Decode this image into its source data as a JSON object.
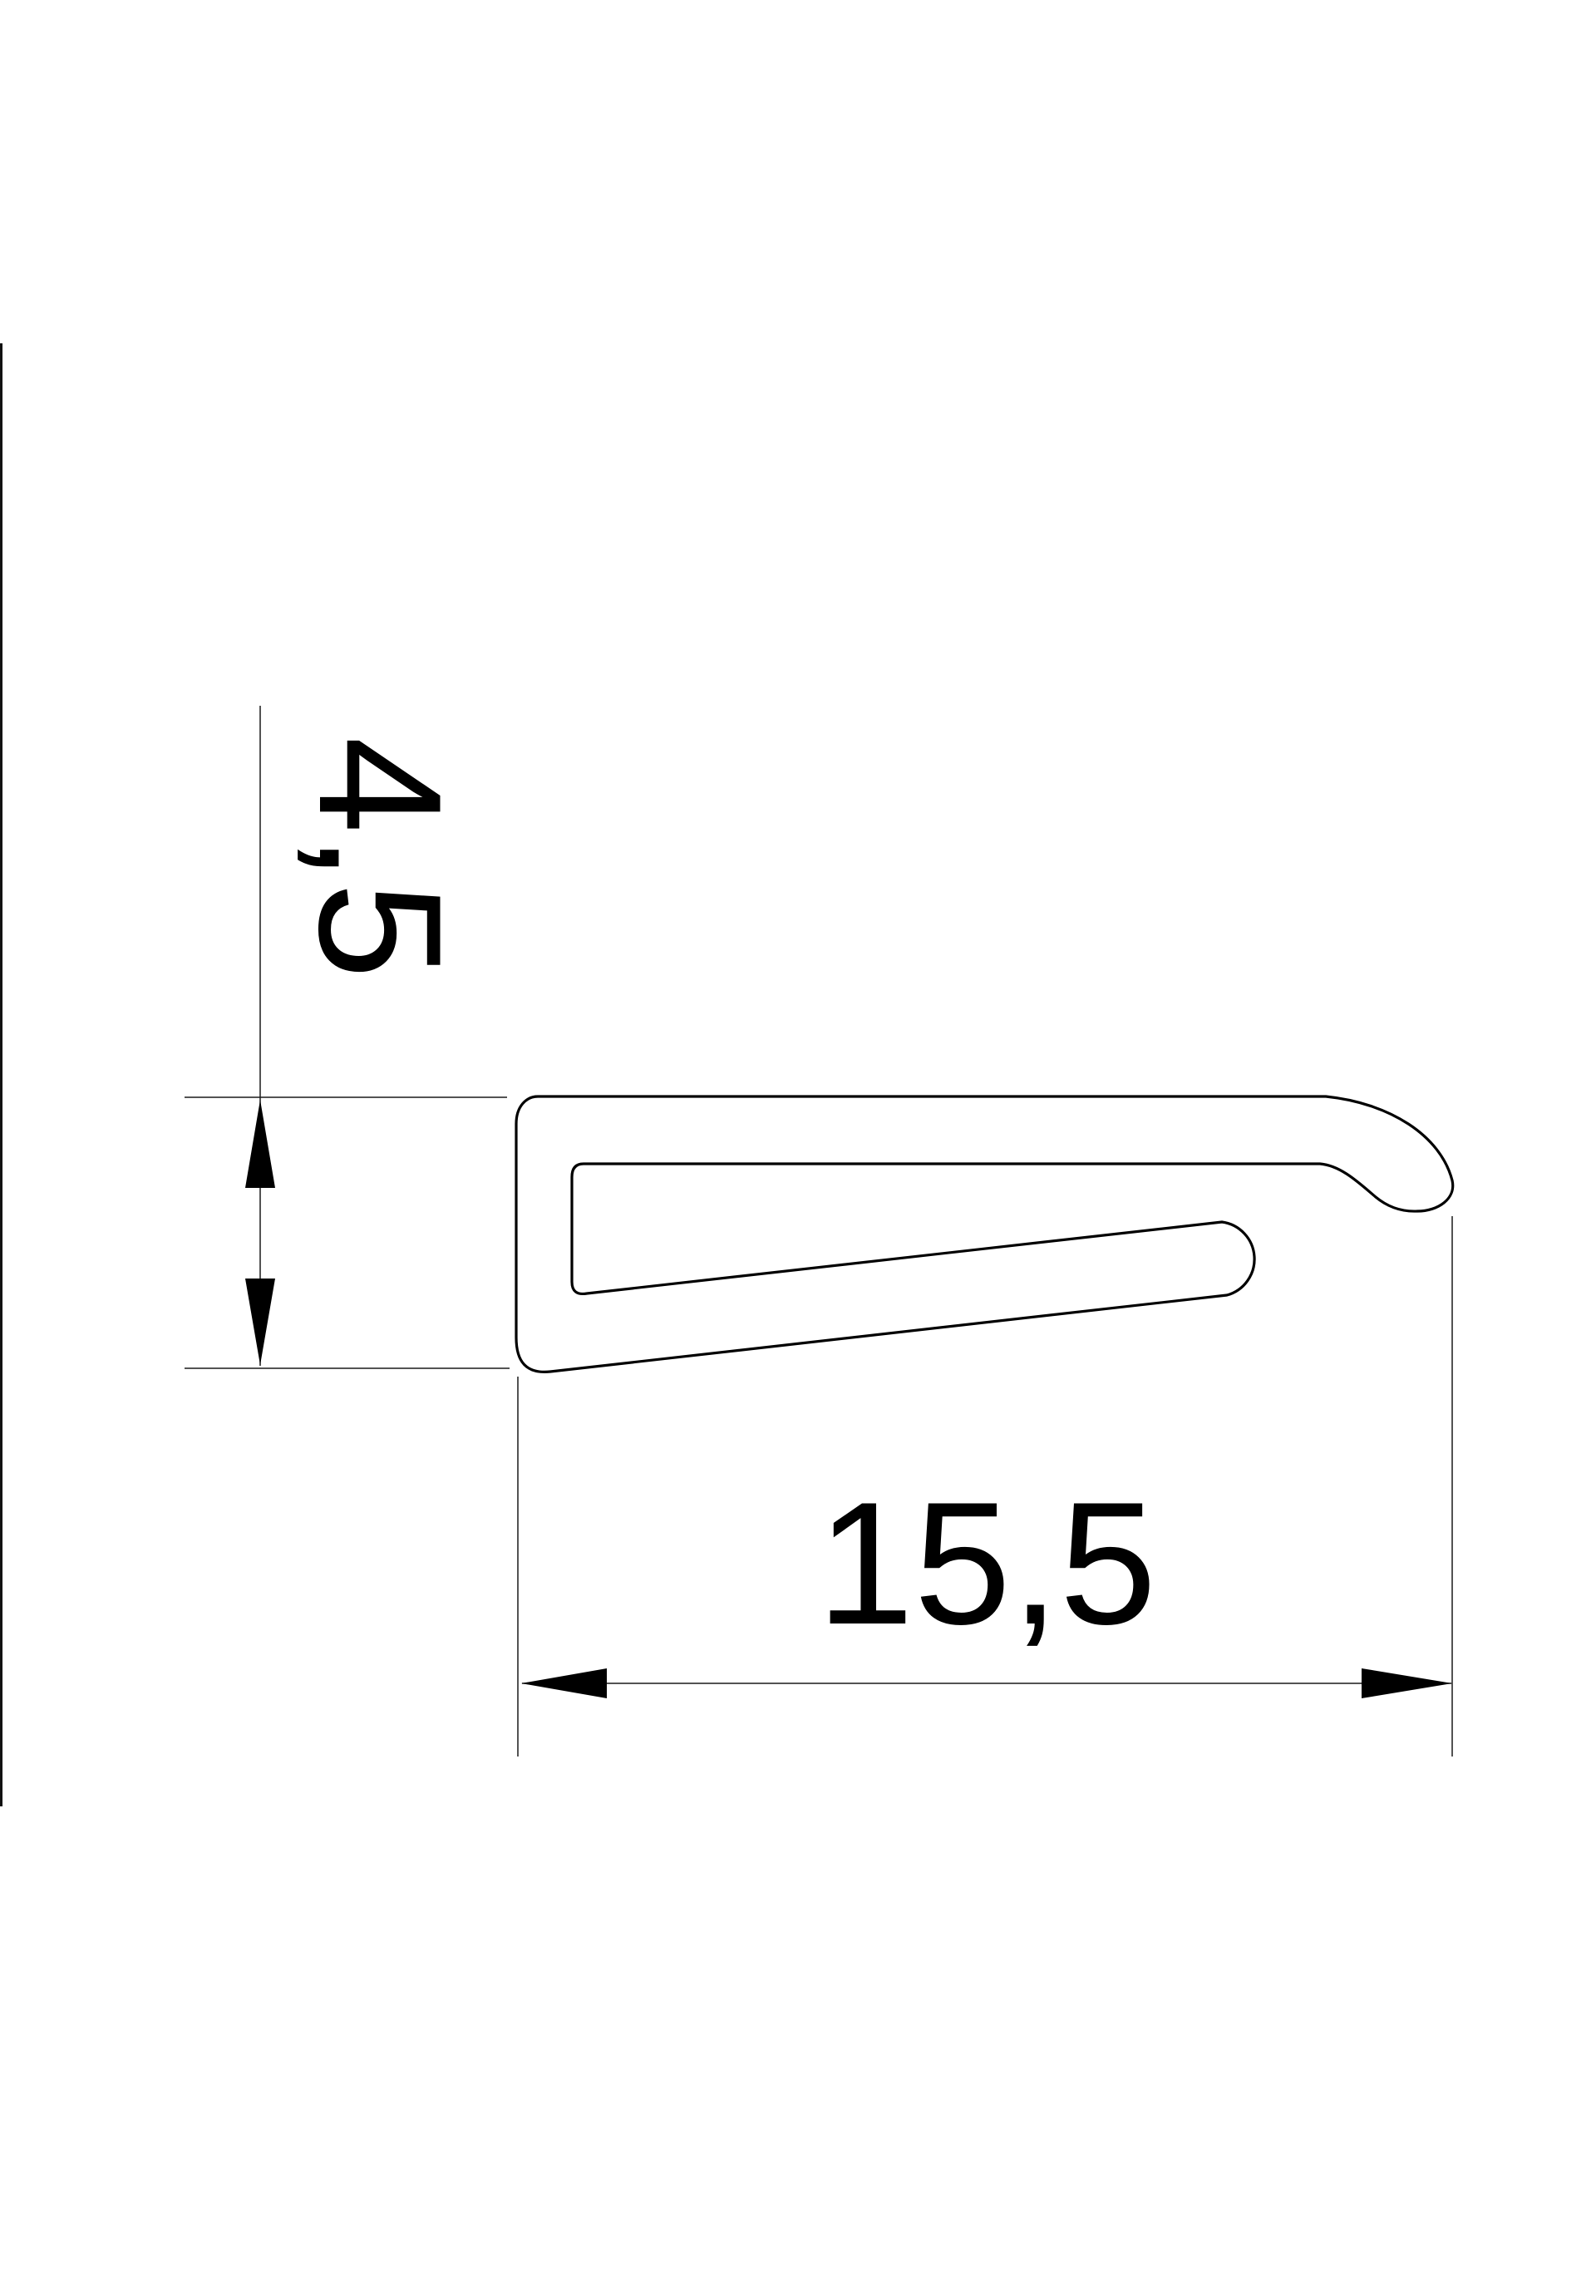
{
  "page": {
    "background": "#ffffff",
    "line_color": "#000000",
    "kind": "technical-drawing-profile-cross-section"
  },
  "dimensions": {
    "height": {
      "label": "4,5",
      "value": 4.5,
      "orientation": "vertical"
    },
    "width": {
      "label": "15,5",
      "value": 15.5,
      "orientation": "horizontal"
    }
  }
}
